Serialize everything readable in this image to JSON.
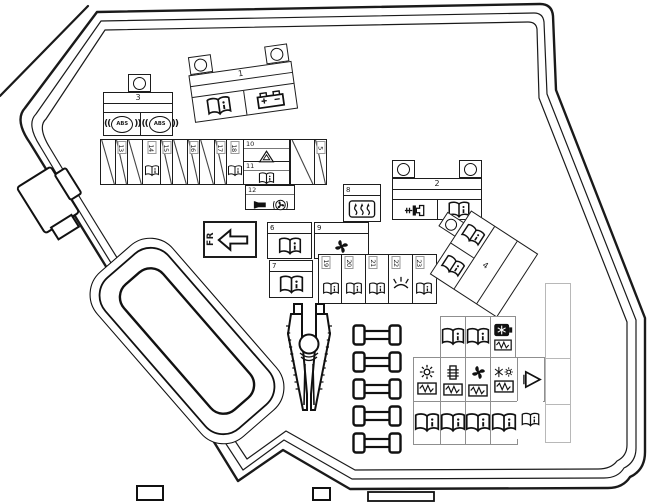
{
  "colors": {
    "line": "#1a1a1a",
    "grid_line": "#8f8f8f",
    "bg": "#ffffff"
  },
  "fr_label": "FR",
  "blocks": {
    "b1": {
      "num": "1",
      "icons": [
        "book-icon",
        "battery-icon"
      ]
    },
    "b2": {
      "num": "2",
      "icons": [
        "lighter-icon",
        "book-icon"
      ]
    },
    "b3": {
      "num": "3",
      "abs": "ABS",
      "icons": [
        "abs-icon",
        "abs-icon"
      ]
    },
    "b4": {
      "num": "4",
      "icons": [
        "book-icon",
        "book-icon"
      ]
    }
  },
  "strip_top": {
    "cells": [
      {
        "num": "",
        "icon": "empty-diagonal"
      },
      {
        "num": "13",
        "icon": "empty-diagonal"
      },
      {
        "num": "",
        "icon": "empty-diagonal"
      },
      {
        "num": "14",
        "icon": "book-icon"
      },
      {
        "num": "15",
        "icon": "empty-diagonal"
      },
      {
        "num": "",
        "icon": "empty-diagonal"
      },
      {
        "num": "16",
        "icon": "empty-diagonal"
      },
      {
        "num": "",
        "icon": "empty-diagonal"
      },
      {
        "num": "17",
        "icon": "empty-diagonal"
      },
      {
        "num": "18",
        "icon": "book-icon"
      }
    ]
  },
  "cells": {
    "c5": {
      "num": "5",
      "icon": "empty-diagonal"
    },
    "c6": {
      "num": "6",
      "icon": "book-icon"
    },
    "c7": {
      "num": "7",
      "icon": "book-icon"
    },
    "c8": {
      "num": "8",
      "icon": "heated-rear-window-icon"
    },
    "c9": {
      "num": "9",
      "icon": "fan-icon"
    },
    "c10": {
      "num": "10",
      "icon": "warning-triangle-icon"
    },
    "c11": {
      "num": "11",
      "icon": "book-icon"
    },
    "c12": {
      "num": "12",
      "icons": [
        "horn-icon",
        "cooling-fan-icon"
      ]
    }
  },
  "strip_mid": {
    "cells": [
      {
        "num": "19",
        "icon": "book-icon"
      },
      {
        "num": "20",
        "icon": "book-icon"
      },
      {
        "num": "21",
        "icon": "book-icon"
      },
      {
        "num": "22",
        "icon": "light-icon"
      },
      {
        "num": "23",
        "icon": "book-icon"
      }
    ]
  },
  "relay_grid": {
    "row1": [
      {
        "icon": "book-icon"
      },
      {
        "icon": "book-icon"
      },
      {
        "icons": [
          "ac-badge-icon",
          "resistor-icon"
        ]
      }
    ],
    "row2": [
      {
        "icons": [
          "sun-icon",
          "resistor-icon"
        ]
      },
      {
        "icons": [
          "glow-plug-icon",
          "resistor-icon"
        ]
      },
      {
        "icons": [
          "fan-icon",
          "resistor-icon"
        ]
      },
      {
        "icons": [
          "snowflake-sun-icon",
          "resistor-icon"
        ]
      },
      {
        "icons": [
          "triangle-right-icon"
        ]
      }
    ],
    "row3": [
      {
        "icon": "book-icon"
      },
      {
        "icon": "book-icon"
      },
      {
        "icon": "book-icon"
      },
      {
        "icon": "book-icon"
      },
      {
        "icon": "book-icon-small"
      }
    ]
  },
  "spare_fuses": 5
}
